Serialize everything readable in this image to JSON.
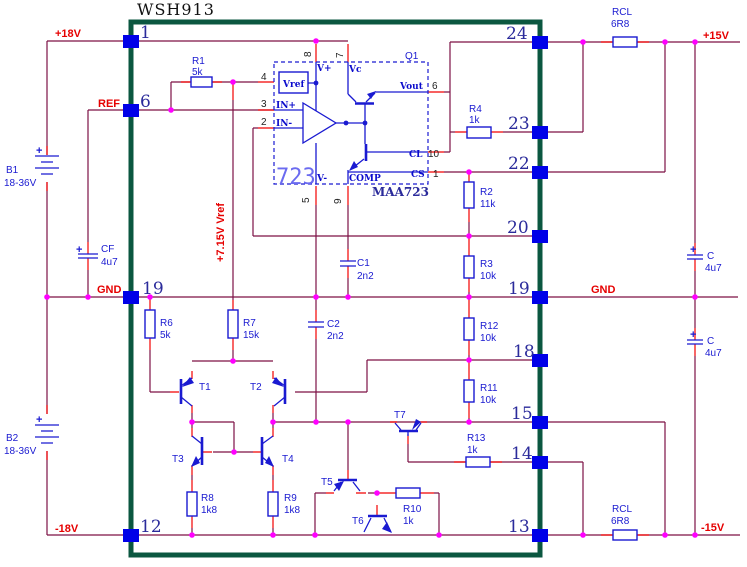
{
  "title": "WSH913",
  "rails": {
    "p18": "+18V",
    "m18": "-18V",
    "p15": "+15V",
    "m15": "-15V",
    "gnd_left": "GND",
    "gnd_right": "GND",
    "ref": "REF",
    "vref_rail": "+7.15V Vref"
  },
  "pins": {
    "n1": "1",
    "n6": "6",
    "n19_left": "19",
    "n12": "12",
    "n24": "24",
    "n23": "23",
    "n22": "22",
    "n20": "20",
    "n19_right": "19",
    "n18": "18",
    "n15": "15",
    "n14": "14",
    "n13": "13"
  },
  "ic723": {
    "label": "723",
    "part": "MAA723",
    "transistor": "Q1",
    "ports": {
      "vref": "Vref",
      "vplus": "V+",
      "vc": "Vc",
      "vminus": "V-",
      "comp": "COMP",
      "in_plus": "IN+",
      "in_minus": "IN-",
      "vout": "Vout",
      "cl": "CL",
      "cs": "CS"
    },
    "pin_numbers": {
      "n8": "8",
      "n7": "7",
      "n4": "4",
      "n3": "3",
      "n2": "2",
      "n5": "5",
      "n9": "9",
      "n6": "6",
      "n10": "10",
      "n1": "1"
    }
  },
  "components": {
    "r1": {
      "ref": "R1",
      "value": "5k"
    },
    "r2": {
      "ref": "R2",
      "value": "11k"
    },
    "r3": {
      "ref": "R3",
      "value": "10k"
    },
    "r4": {
      "ref": "R4",
      "value": "1k"
    },
    "r6": {
      "ref": "R6",
      "value": "5k"
    },
    "r7": {
      "ref": "R7",
      "value": "15k"
    },
    "r8": {
      "ref": "R8",
      "value": "1k8"
    },
    "r9": {
      "ref": "R9",
      "value": "1k8"
    },
    "r10": {
      "ref": "R10",
      "value": "1k"
    },
    "r11": {
      "ref": "R11",
      "value": "10k"
    },
    "r12": {
      "ref": "R12",
      "value": "10k"
    },
    "r13": {
      "ref": "R13",
      "value": "1k"
    },
    "rcl_top": {
      "ref": "RCL",
      "value": "6R8"
    },
    "rcl_bottom": {
      "ref": "RCL",
      "value": "6R8"
    },
    "c1": {
      "ref": "C1",
      "value": "2n2"
    },
    "c2": {
      "ref": "C2",
      "value": "2n2"
    },
    "cf": {
      "ref": "CF",
      "value": "4u7"
    },
    "c_top": {
      "ref": "C",
      "value": "4u7"
    },
    "c_bottom": {
      "ref": "C",
      "value": "4u7"
    },
    "b1": {
      "ref": "B1",
      "value": "18-36V"
    },
    "b2": {
      "ref": "B2",
      "value": "18-36V"
    },
    "t1": {
      "ref": "T1"
    },
    "t2": {
      "ref": "T2"
    },
    "t3": {
      "ref": "T3"
    },
    "t4": {
      "ref": "T4"
    },
    "t5": {
      "ref": "T5"
    },
    "t6": {
      "ref": "T6"
    },
    "t7": {
      "ref": "T7"
    }
  },
  "symbols": {
    "plus": "+"
  },
  "colors": {
    "wire": "#7d1145",
    "stub": "#f20000",
    "component": "#1a1ad1",
    "pad": "#0000e8",
    "junction": "#ff00ff",
    "chip_border": "#0b5740",
    "pin_number": "#2b2b9b",
    "label_red": "#e60000",
    "ic_text": "#6b6bf0",
    "background": "#ffffff"
  }
}
